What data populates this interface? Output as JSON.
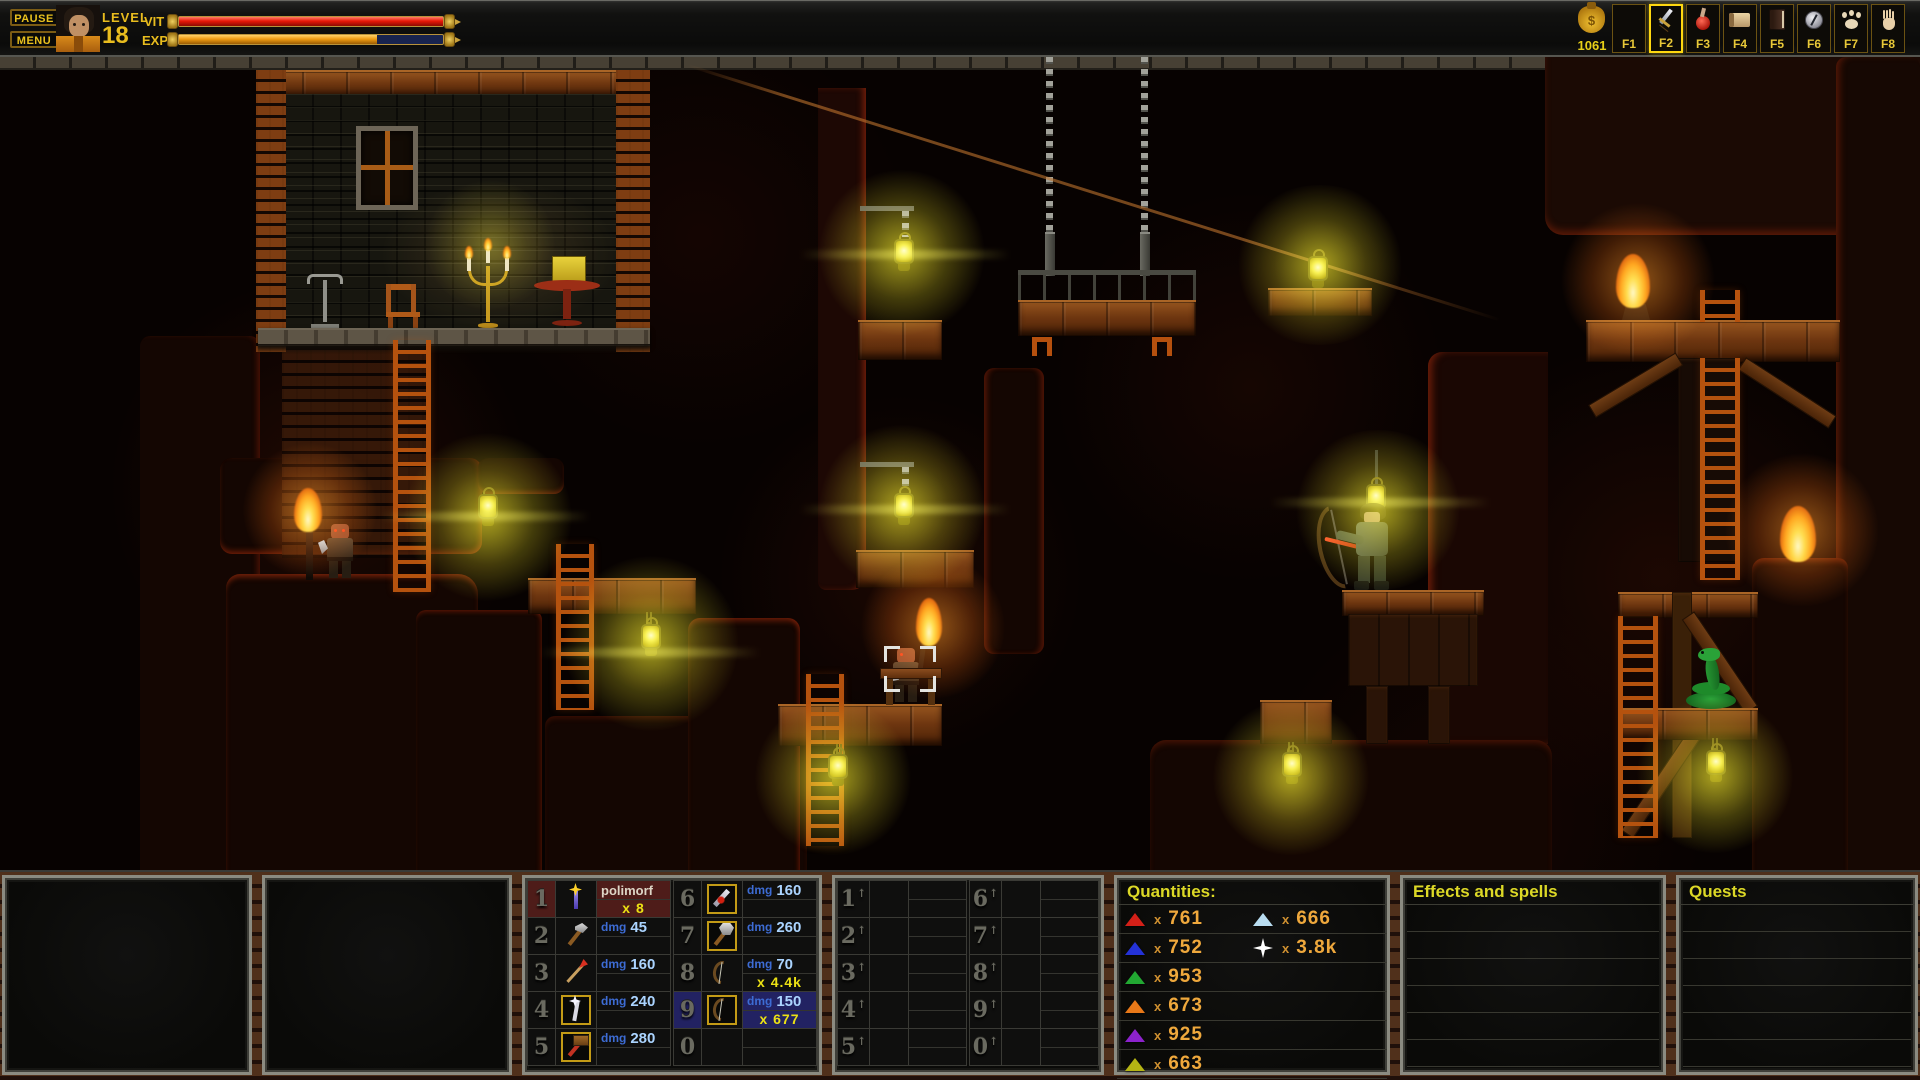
{
  "topbar": {
    "pause_label": "PAUSE",
    "menu_label": "MENU",
    "level_label": "LEVEL",
    "level_value": "18",
    "vit_label": "VIT",
    "exp_label": "EXP",
    "vit_percent": 100,
    "exp_percent": 75,
    "gold_amount": "1061",
    "fkeys": [
      {
        "label": "F1",
        "icon": "empty",
        "selected": false
      },
      {
        "label": "F2",
        "icon": "sword",
        "selected": true
      },
      {
        "label": "F3",
        "icon": "potion",
        "selected": false
      },
      {
        "label": "F4",
        "icon": "scroll",
        "selected": false
      },
      {
        "label": "F5",
        "icon": "book",
        "selected": false
      },
      {
        "label": "F6",
        "icon": "compass",
        "selected": false
      },
      {
        "label": "F7",
        "icon": "paw",
        "selected": false
      },
      {
        "label": "F8",
        "icon": "hand",
        "selected": false
      }
    ]
  },
  "hotbar": {
    "dmg_label": "dmg",
    "slots": [
      {
        "key": "1",
        "icon": "polymorph-wand",
        "name": "polimorf",
        "count": "x 8",
        "variant": "red"
      },
      {
        "key": "2",
        "icon": "axe",
        "dmg": "45"
      },
      {
        "key": "3",
        "icon": "spear",
        "dmg": "160"
      },
      {
        "key": "4",
        "icon": "scepter",
        "dmg": "240",
        "equipped": true
      },
      {
        "key": "5",
        "icon": "hammer",
        "dmg": "280",
        "equipped": true
      },
      {
        "key": "6",
        "icon": "dagger",
        "dmg": "160",
        "equipped": true
      },
      {
        "key": "7",
        "icon": "battle-axe",
        "dmg": "260",
        "equipped": true
      },
      {
        "key": "8",
        "icon": "bow",
        "dmg": "70",
        "count": "x 4.4k"
      },
      {
        "key": "9",
        "icon": "bow",
        "dmg": "150",
        "count": "x 677",
        "variant": "blue",
        "equipped": true
      },
      {
        "key": "0",
        "icon": "empty"
      }
    ]
  },
  "hotbar_shift": {
    "shift_marker": "↑",
    "keys": [
      "1",
      "2",
      "3",
      "4",
      "5",
      "6",
      "7",
      "8",
      "9",
      "0"
    ]
  },
  "quantities": {
    "title": "Quantities:",
    "multiplier": "x",
    "col1": [
      {
        "icon": "triangle",
        "color": "#d42018",
        "count": "761"
      },
      {
        "icon": "triangle",
        "color": "#2432d8",
        "count": "752"
      },
      {
        "icon": "triangle",
        "color": "#22a832",
        "count": "953"
      },
      {
        "icon": "triangle",
        "color": "#e87818",
        "count": "673"
      },
      {
        "icon": "triangle",
        "color": "#8c22cc",
        "count": "925"
      },
      {
        "icon": "triangle",
        "color": "#b4b414",
        "count": "663"
      }
    ],
    "col2": [
      {
        "icon": "triangle",
        "color": "#b8dcf0",
        "count": "666"
      },
      {
        "icon": "star",
        "color": "#ffffff",
        "count": "3.8k"
      }
    ]
  },
  "effects_panel": {
    "title": "Effects and spells"
  },
  "quests_panel": {
    "title": "Quests"
  },
  "colors": {
    "accent_yellow": "#e8d21e",
    "hp_red": "#e02020",
    "exp_orange": "#eca414",
    "dmg_blue": "#3d6cd4",
    "dmg_value": "#abd4ff",
    "count_yellow": "#ece114",
    "quantity_text": "#efa83c",
    "panel_title": "#dcd826"
  }
}
